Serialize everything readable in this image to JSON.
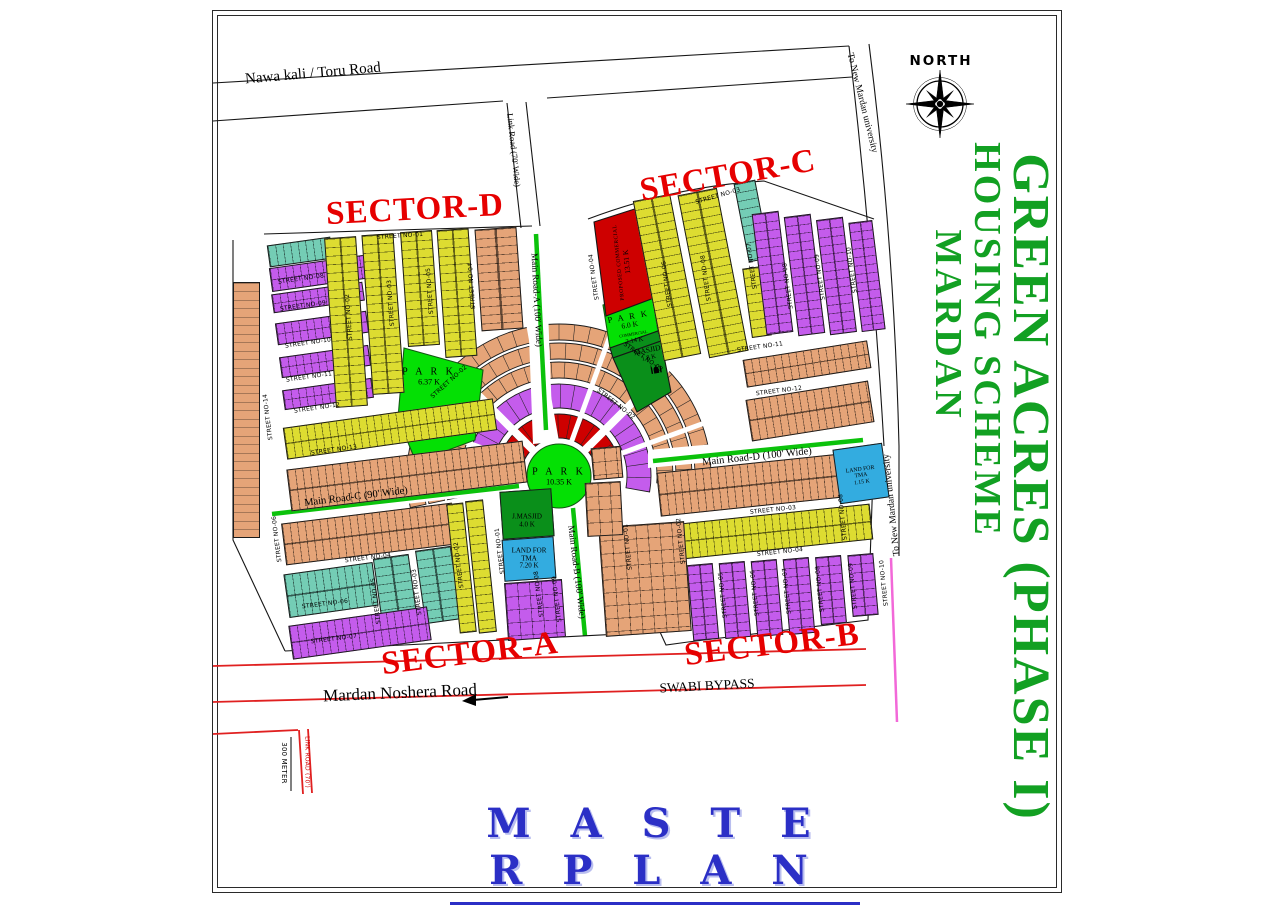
{
  "north_label": "NORTH",
  "title": {
    "line1": "GREEN ACRES (PHASE I)",
    "line2": "HOUSING SCHEME",
    "line3": "MARDAN"
  },
  "plan_title": "M A S T E R  P L A N",
  "sectors": [
    {
      "label": "SECTOR-D",
      "x": 415,
      "y": 210,
      "rot": -3
    },
    {
      "label": "SECTOR-C",
      "x": 728,
      "y": 176,
      "rot": -10
    },
    {
      "label": "SECTOR-A",
      "x": 470,
      "y": 654,
      "rot": -7
    },
    {
      "label": "SECTOR-B",
      "x": 772,
      "y": 645,
      "rot": -7
    }
  ],
  "roads": {
    "nawa_kali": {
      "label": "Nawa kali / Toru Road",
      "x": 313,
      "y": 74,
      "rot": -5,
      "size": 15
    },
    "link_road": {
      "label": "Link Road (70' Wide)",
      "x": 514,
      "y": 150,
      "rot": 84,
      "size": 8.5
    },
    "to_university_top": {
      "label": "To  New  Mardan  university",
      "x": 862,
      "y": 103,
      "rot": 76,
      "size": 9.5
    },
    "to_university_right": {
      "label": "To  New  Mardan  university",
      "x": 892,
      "y": 505,
      "rot": -96,
      "size": 9.5
    },
    "main_road_a": {
      "label": "Main Road-A (100' Wide)",
      "x": 537,
      "y": 300,
      "rot": 87,
      "size": 9
    },
    "main_road_b": {
      "label": "Main Road-B (100' Wide)",
      "x": 577,
      "y": 572,
      "rot": 83,
      "size": 9
    },
    "main_road_c": {
      "label": "Main Road-C (90' Wide)",
      "x": 356,
      "y": 497,
      "rot": -7,
      "size": 10.5
    },
    "main_road_d": {
      "label": "Main Road-D (100' Wide)",
      "x": 757,
      "y": 457,
      "rot": -6,
      "size": 10.5
    },
    "mardan_noshera": {
      "label": "Mardan Noshera Road",
      "x": 400,
      "y": 693,
      "rot": -2.5,
      "size": 17
    },
    "swabi_bypass": {
      "label": "SWABI BYPASS",
      "x": 707,
      "y": 686,
      "rot": -3,
      "size": 13.5
    },
    "scale_300m": {
      "label": "300 METER",
      "x": 284,
      "y": 763,
      "rot": 90,
      "size": 7,
      "sans": true
    },
    "link_road_bottom": {
      "label": "LINK ROAD (70')",
      "x": 307,
      "y": 762,
      "rot": 90,
      "size": 6,
      "sans": true,
      "color": "#D00000"
    }
  },
  "amenities": {
    "park_central": {
      "line1": "P A R K",
      "line2": "10.35 K"
    },
    "park_d": {
      "line1": "P A R K",
      "line2": "6.37 K"
    },
    "park_c": {
      "line1": "P A R K",
      "line2": "6.0 K"
    },
    "commercial_strip": {
      "line1": "COMMERCIAL",
      "line2": "2.14 K"
    },
    "masjid_c": {
      "line1": "MASJID",
      "line2": "1.8 K"
    },
    "jamia_masjid": {
      "line1": "J.MASJID",
      "line2": "4.0 K"
    },
    "tma_a": {
      "line1": "LAND FOR",
      "line2": "TMA",
      "line3": "7.20 K"
    },
    "tma_b": {
      "line1": "LAND FOR",
      "line2": "TMA",
      "line3": "1.15 K"
    },
    "commercial_red": {
      "line1": "PROPOSED COMMERCIAL",
      "line2": "13.51 K"
    }
  },
  "streets": [
    {
      "label": "STREET NO-01",
      "x": 400,
      "y": 236,
      "rot": -4
    },
    {
      "label": "STREET NO-08",
      "x": 301,
      "y": 279,
      "rot": -8
    },
    {
      "label": "STREET NO-09",
      "x": 303,
      "y": 306,
      "rot": -8
    },
    {
      "label": "STREET NO-10",
      "x": 308,
      "y": 343,
      "rot": -8
    },
    {
      "label": "STREET NO-11",
      "x": 309,
      "y": 377,
      "rot": -8
    },
    {
      "label": "STREET NO-12",
      "x": 317,
      "y": 408,
      "rot": -8
    },
    {
      "label": "STREET NO-13",
      "x": 334,
      "y": 450,
      "rot": -8
    },
    {
      "label": "STREET NO-14",
      "x": 268,
      "y": 417,
      "rot": -97
    },
    {
      "label": "STREET NO-02",
      "x": 349,
      "y": 317,
      "rot": -94
    },
    {
      "label": "STREET NO-03",
      "x": 391,
      "y": 303,
      "rot": -94
    },
    {
      "label": "STREET NO-05",
      "x": 430,
      "y": 291,
      "rot": -94
    },
    {
      "label": "STREET NO-04",
      "x": 472,
      "y": 286,
      "rot": -94
    },
    {
      "label": "STREET NO-02",
      "x": 449,
      "y": 382,
      "rot": -42
    },
    {
      "label": "STREET NO-03",
      "x": 718,
      "y": 196,
      "rot": -16
    },
    {
      "label": "STREET NO-04",
      "x": 594,
      "y": 277,
      "rot": -98
    },
    {
      "label": "STREET NO-06",
      "x": 667,
      "y": 284,
      "rot": -98
    },
    {
      "label": "STREET NO-08",
      "x": 706,
      "y": 278,
      "rot": -98
    },
    {
      "label": "STREET NO-07",
      "x": 752,
      "y": 266,
      "rot": -98
    },
    {
      "label": "STREET NO-08",
      "x": 788,
      "y": 286,
      "rot": -98
    },
    {
      "label": "STREET NO-09",
      "x": 820,
      "y": 277,
      "rot": -98
    },
    {
      "label": "STREET NO-10",
      "x": 852,
      "y": 270,
      "rot": -98
    },
    {
      "label": "STREET NO-11",
      "x": 760,
      "y": 347,
      "rot": -8
    },
    {
      "label": "STREET NO-12",
      "x": 779,
      "y": 391,
      "rot": -7
    },
    {
      "label": "STREET NO-03",
      "x": 643,
      "y": 357,
      "rot": 35
    },
    {
      "label": "STREET NO-02",
      "x": 616,
      "y": 404,
      "rot": 38
    },
    {
      "label": "STREET NO-04",
      "x": 368,
      "y": 558,
      "rot": -7
    },
    {
      "label": "STREET NO-06",
      "x": 325,
      "y": 604,
      "rot": -7
    },
    {
      "label": "STREET NO-07",
      "x": 334,
      "y": 639,
      "rot": -7
    },
    {
      "label": "STREET NO-06",
      "x": 277,
      "y": 539,
      "rot": -97
    },
    {
      "label": "STREET NO-05",
      "x": 376,
      "y": 601,
      "rot": -97
    },
    {
      "label": "STREET NO-03",
      "x": 417,
      "y": 592,
      "rot": -97
    },
    {
      "label": "STREET NO-02",
      "x": 459,
      "y": 565,
      "rot": -97
    },
    {
      "label": "STREET NO-01",
      "x": 500,
      "y": 551,
      "rot": -97
    },
    {
      "label": "STREET NO-08",
      "x": 539,
      "y": 594,
      "rot": -97
    },
    {
      "label": "STREET NO-09",
      "x": 557,
      "y": 599,
      "rot": -97
    },
    {
      "label": "STREET NO-03",
      "x": 773,
      "y": 510,
      "rot": -6
    },
    {
      "label": "STREET NO-04",
      "x": 780,
      "y": 552,
      "rot": -6
    },
    {
      "label": "STREET NO-08",
      "x": 843,
      "y": 517,
      "rot": -96
    },
    {
      "label": "STREET NO-05",
      "x": 723,
      "y": 595,
      "rot": -96
    },
    {
      "label": "STREET NO-06",
      "x": 755,
      "y": 593,
      "rot": -96
    },
    {
      "label": "STREET NO-07",
      "x": 787,
      "y": 591,
      "rot": -96
    },
    {
      "label": "STREET NO-08",
      "x": 820,
      "y": 589,
      "rot": -96
    },
    {
      "label": "STREET NO-09",
      "x": 853,
      "y": 586,
      "rot": -96
    },
    {
      "label": "STREET NO-10",
      "x": 884,
      "y": 583,
      "rot": -96
    },
    {
      "label": "STREET NO-01",
      "x": 628,
      "y": 547,
      "rot": -96
    },
    {
      "label": "STREET NO-02",
      "x": 681,
      "y": 541,
      "rot": -96
    }
  ],
  "palette": {
    "tan": "#E5A478",
    "yellow": "#DDDC31",
    "purple": "#C45CEC",
    "teal": "#74CDB5",
    "red_ring": "#CE0000",
    "park_green": "#04E004",
    "dark_green": "#0A8F1A",
    "tma_blue": "#33ACE0",
    "road_green": "#0BC20B",
    "sector_red": "#E60000",
    "line_red": "#E02020",
    "pink": "#F268D8",
    "title_green": "#12A022"
  }
}
